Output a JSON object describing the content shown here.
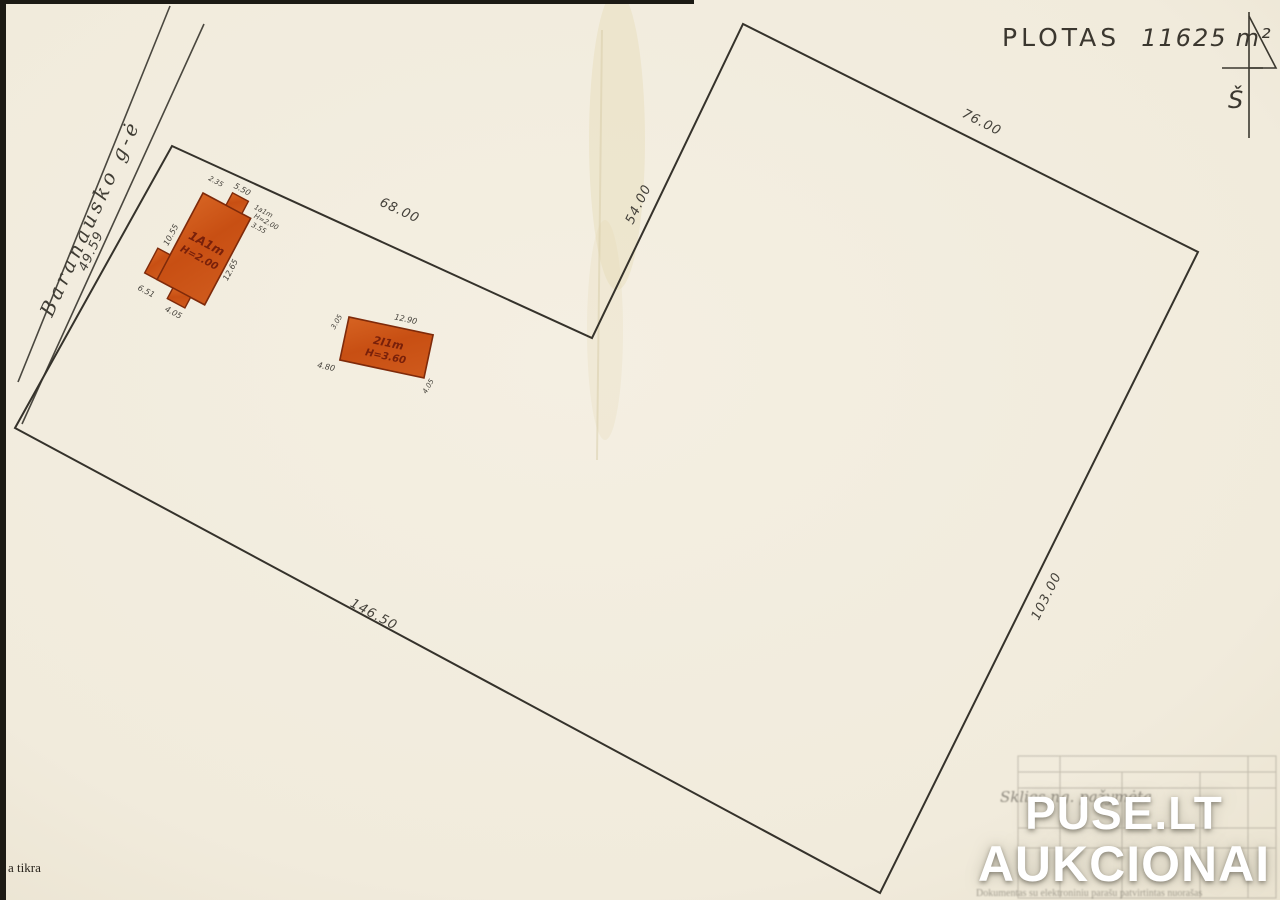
{
  "document": {
    "area_label": "PLOTAS",
    "area_value": "11625",
    "area_unit": "m²"
  },
  "north_arrow": {
    "label": "Š"
  },
  "street": {
    "name": "Baranausko g-ė",
    "frontage_length": "49.59"
  },
  "boundary_dimensions": {
    "top_edge": "68.00",
    "inner_diagonal_edge": "54.00",
    "north_east_edge": "76.00",
    "south_east_edge": "103.00",
    "south_west_edge": "146.50"
  },
  "buildings": [
    {
      "label": "1A1m",
      "height": "H=2.00",
      "dims": {
        "top": "5.50",
        "top_left": "2.35",
        "left": "10.55",
        "right": "12.65",
        "bottom_left": "6.51",
        "bottom": "4.05",
        "annex_label": "1a1m",
        "annex_height": "H=2.00",
        "annex_dim": "3.55"
      }
    },
    {
      "label": "2I1m",
      "height": "H=3.60",
      "dims": {
        "top": "12.90",
        "left_top": "3.05",
        "left_bottom": "4.80",
        "right": "4.05"
      }
    }
  ],
  "watermark": {
    "line1": "PUSE.LT",
    "line2": "AUKCIONAI"
  },
  "notes": {
    "left_note": "a tikra",
    "handwritten_note": "Sklies ng. pažymėta",
    "footer_note": "Dokumentas su elektroniniu parašu patvirtintas nuorašas"
  }
}
